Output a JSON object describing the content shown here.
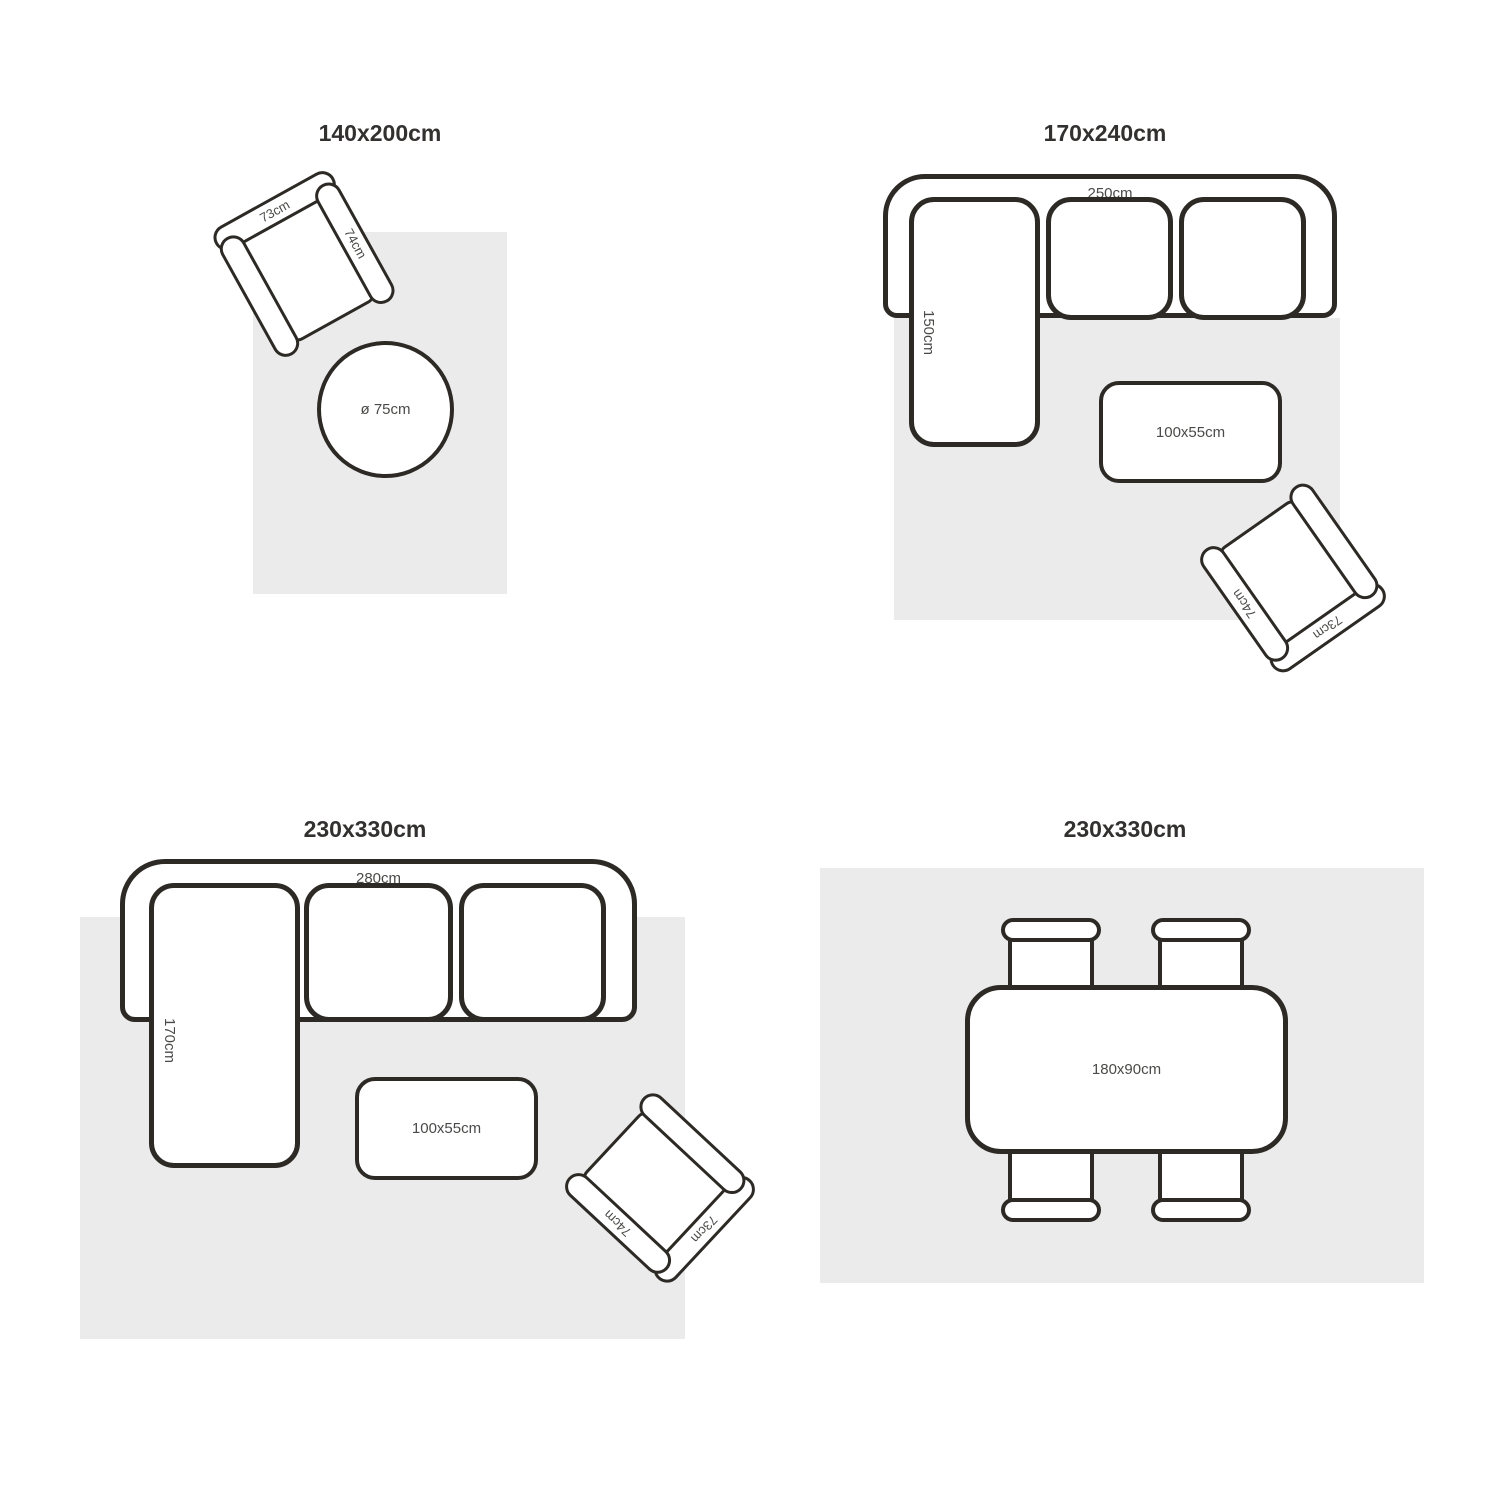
{
  "colors": {
    "background": "#ffffff",
    "rug_fill": "#ebebeb",
    "furniture_outline": "#2d2a26",
    "furniture_fill": "#ffffff",
    "title_text": "#333130",
    "label_text": "#4a4a48"
  },
  "quadrants": {
    "q1": {
      "title": "140x200cm",
      "armchair": {
        "back_label": "73cm",
        "arm_label": "74cm"
      },
      "round_table": {
        "label": "ø 75cm"
      }
    },
    "q2": {
      "title": "170x240cm",
      "sofa": {
        "width_label": "250cm",
        "chaise_label": "150cm"
      },
      "coffee_table": {
        "label": "100x55cm"
      },
      "armchair": {
        "back_label": "73cm",
        "arm_label": "74cm"
      }
    },
    "q3": {
      "title": "230x330cm",
      "sofa": {
        "width_label": "280cm",
        "chaise_label": "170cm"
      },
      "coffee_table": {
        "label": "100x55cm"
      },
      "armchair": {
        "back_label": "73cm",
        "arm_label": "74cm"
      }
    },
    "q4": {
      "title": "230x330cm",
      "dining_table": {
        "label": "180x90cm"
      }
    }
  }
}
